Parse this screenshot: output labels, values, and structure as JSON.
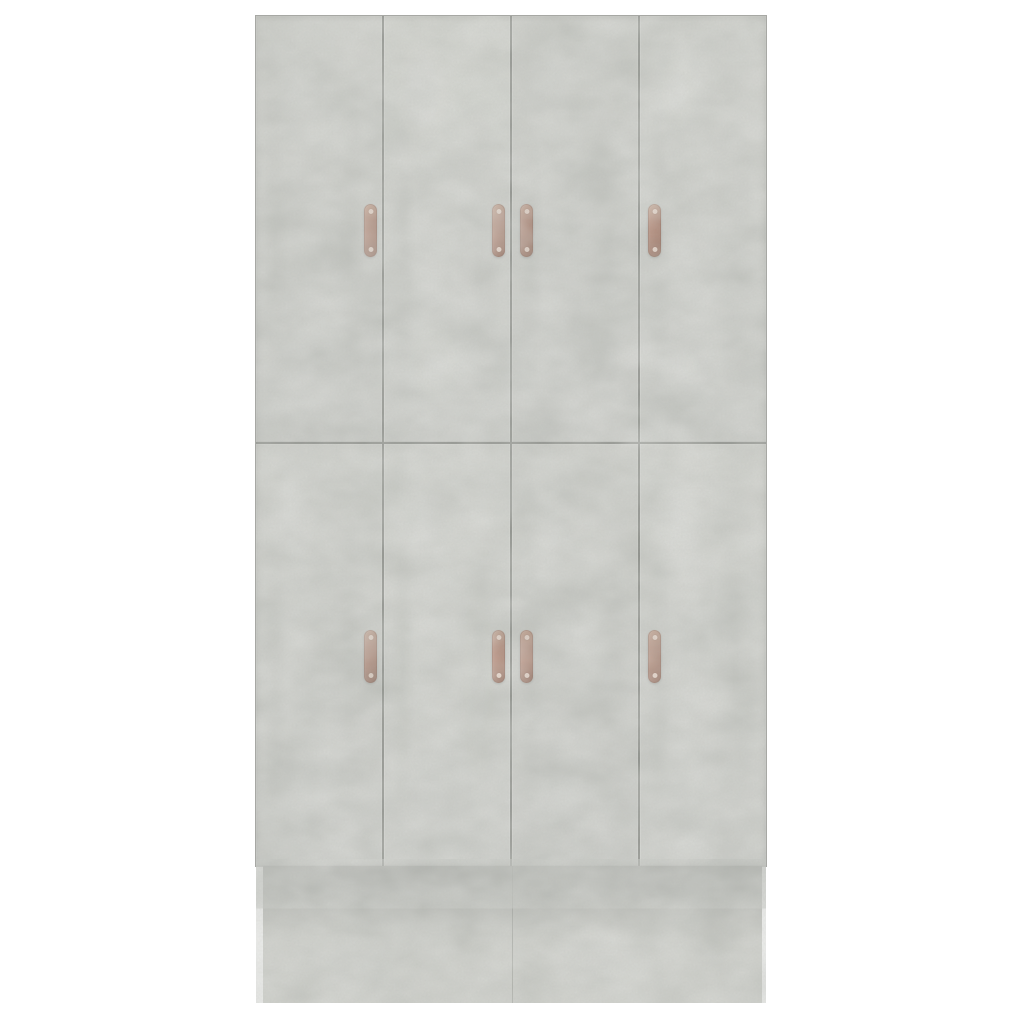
{
  "scene": {
    "description": "Front view of an eight-door wardrobe in concrete grey with copper strap handles on a plain white background",
    "object": "wardrobe",
    "door_count": 8,
    "handle_count": 8,
    "rows": 2,
    "columns": 4
  },
  "colors": {
    "background": "#ffffff",
    "concrete": "#cbccc8",
    "concrete_light": "#d7d7d4",
    "concrete_dark": "#b3b5b0",
    "seam": "#6f716c",
    "edge": "#a7a8a4",
    "base_shadow": "#75766f",
    "handle_copper": "#aa6a52",
    "handle_copper_light": "#c08a6e",
    "handle_copper_dark": "#84462f",
    "handle_screw": "#eccfc0"
  },
  "wardrobe": {
    "doors": [
      {
        "id": "top-1",
        "row": "top",
        "handle_side": "right"
      },
      {
        "id": "top-2",
        "row": "top",
        "handle_side": "right"
      },
      {
        "id": "top-3",
        "row": "top",
        "handle_side": "left"
      },
      {
        "id": "top-4",
        "row": "top",
        "handle_side": "left"
      },
      {
        "id": "bottom-1",
        "row": "bottom",
        "handle_side": "right"
      },
      {
        "id": "bottom-2",
        "row": "bottom",
        "handle_side": "right"
      },
      {
        "id": "bottom-3",
        "row": "bottom",
        "handle_side": "left"
      },
      {
        "id": "bottom-4",
        "row": "bottom",
        "handle_side": "left"
      }
    ],
    "base_panels": 2
  }
}
